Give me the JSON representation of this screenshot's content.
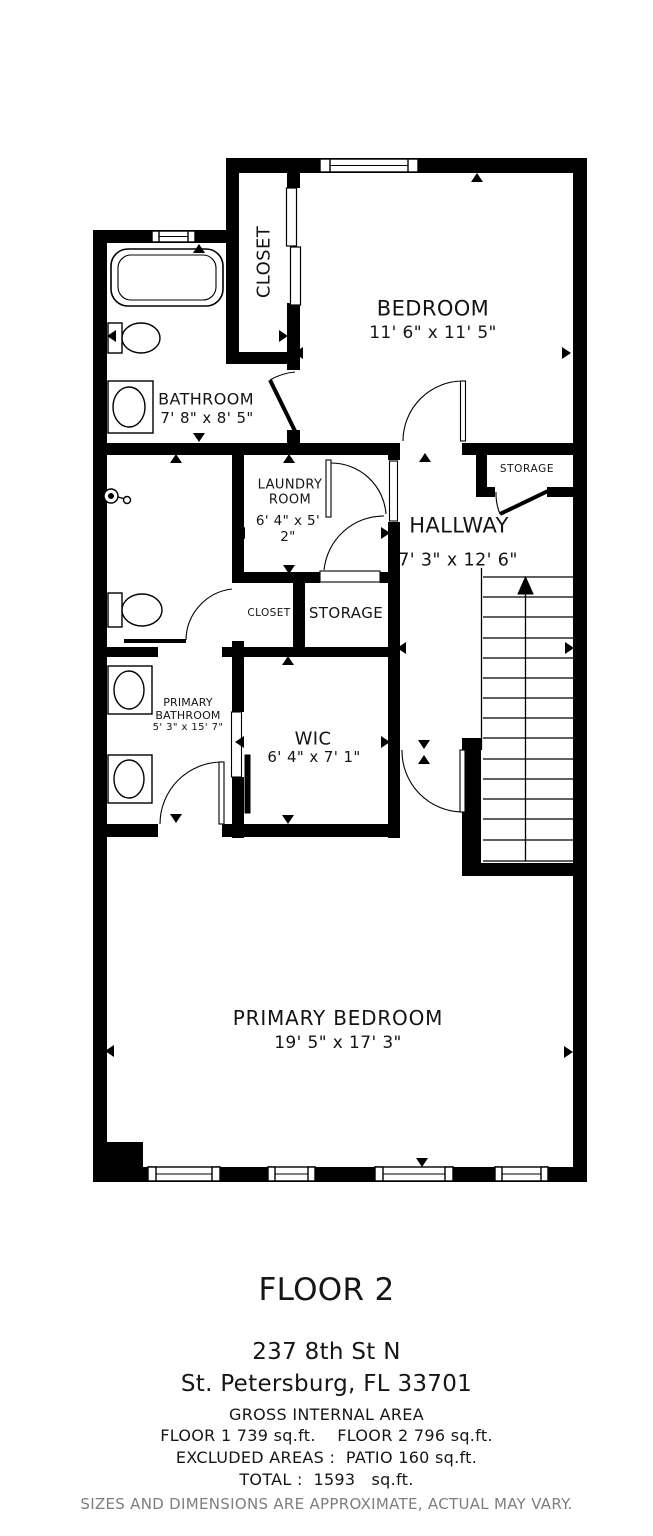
{
  "plan": {
    "rooms": {
      "bedroom": {
        "name": "BEDROOM",
        "dims": "11' 6\" x 11' 5\""
      },
      "bathroom": {
        "name": "BATHROOM",
        "dims": "7' 8\" x 8' 5\""
      },
      "closet_upper": {
        "name": "CLOSET"
      },
      "laundry": {
        "name": "LAUNDRY ROOM",
        "dims": "6' 4\" x 5' 2\""
      },
      "hallway": {
        "name": "HALLWAY",
        "dims": "7' 3\" x 12' 6\""
      },
      "storage_hall": {
        "name": "STORAGE"
      },
      "closet_small": {
        "name": "CLOSET"
      },
      "storage_mid": {
        "name": "STORAGE"
      },
      "primary_bathroom": {
        "name": "PRIMARY BATHROOM",
        "dims": "5' 3\" x 15' 7\""
      },
      "wic": {
        "name": "WIC",
        "dims": "6' 4\" x 7' 1\""
      },
      "primary_bedroom": {
        "name": "PRIMARY BEDROOM",
        "dims": "19' 5\" x 17' 3\""
      }
    }
  },
  "footer": {
    "floor_title": "FLOOR 2",
    "address_line1": "237 8th St N",
    "address_line2": "St. Petersburg, FL 33701",
    "area_header": "GROSS INTERNAL AREA",
    "area_line1": "FLOOR 1 739 sq.ft.    FLOOR 2 796 sq.ft.",
    "area_line2": "EXCLUDED AREAS :  PATIO 160 sq.ft.",
    "area_line3": "TOTAL :  1593   sq.ft.",
    "disclaimer": "SIZES AND DIMENSIONS ARE APPROXIMATE, ACTUAL MAY VARY."
  },
  "colors": {
    "wall": "#000000",
    "text": "#141414",
    "disclaimer_gray": "#7e7e7e"
  }
}
